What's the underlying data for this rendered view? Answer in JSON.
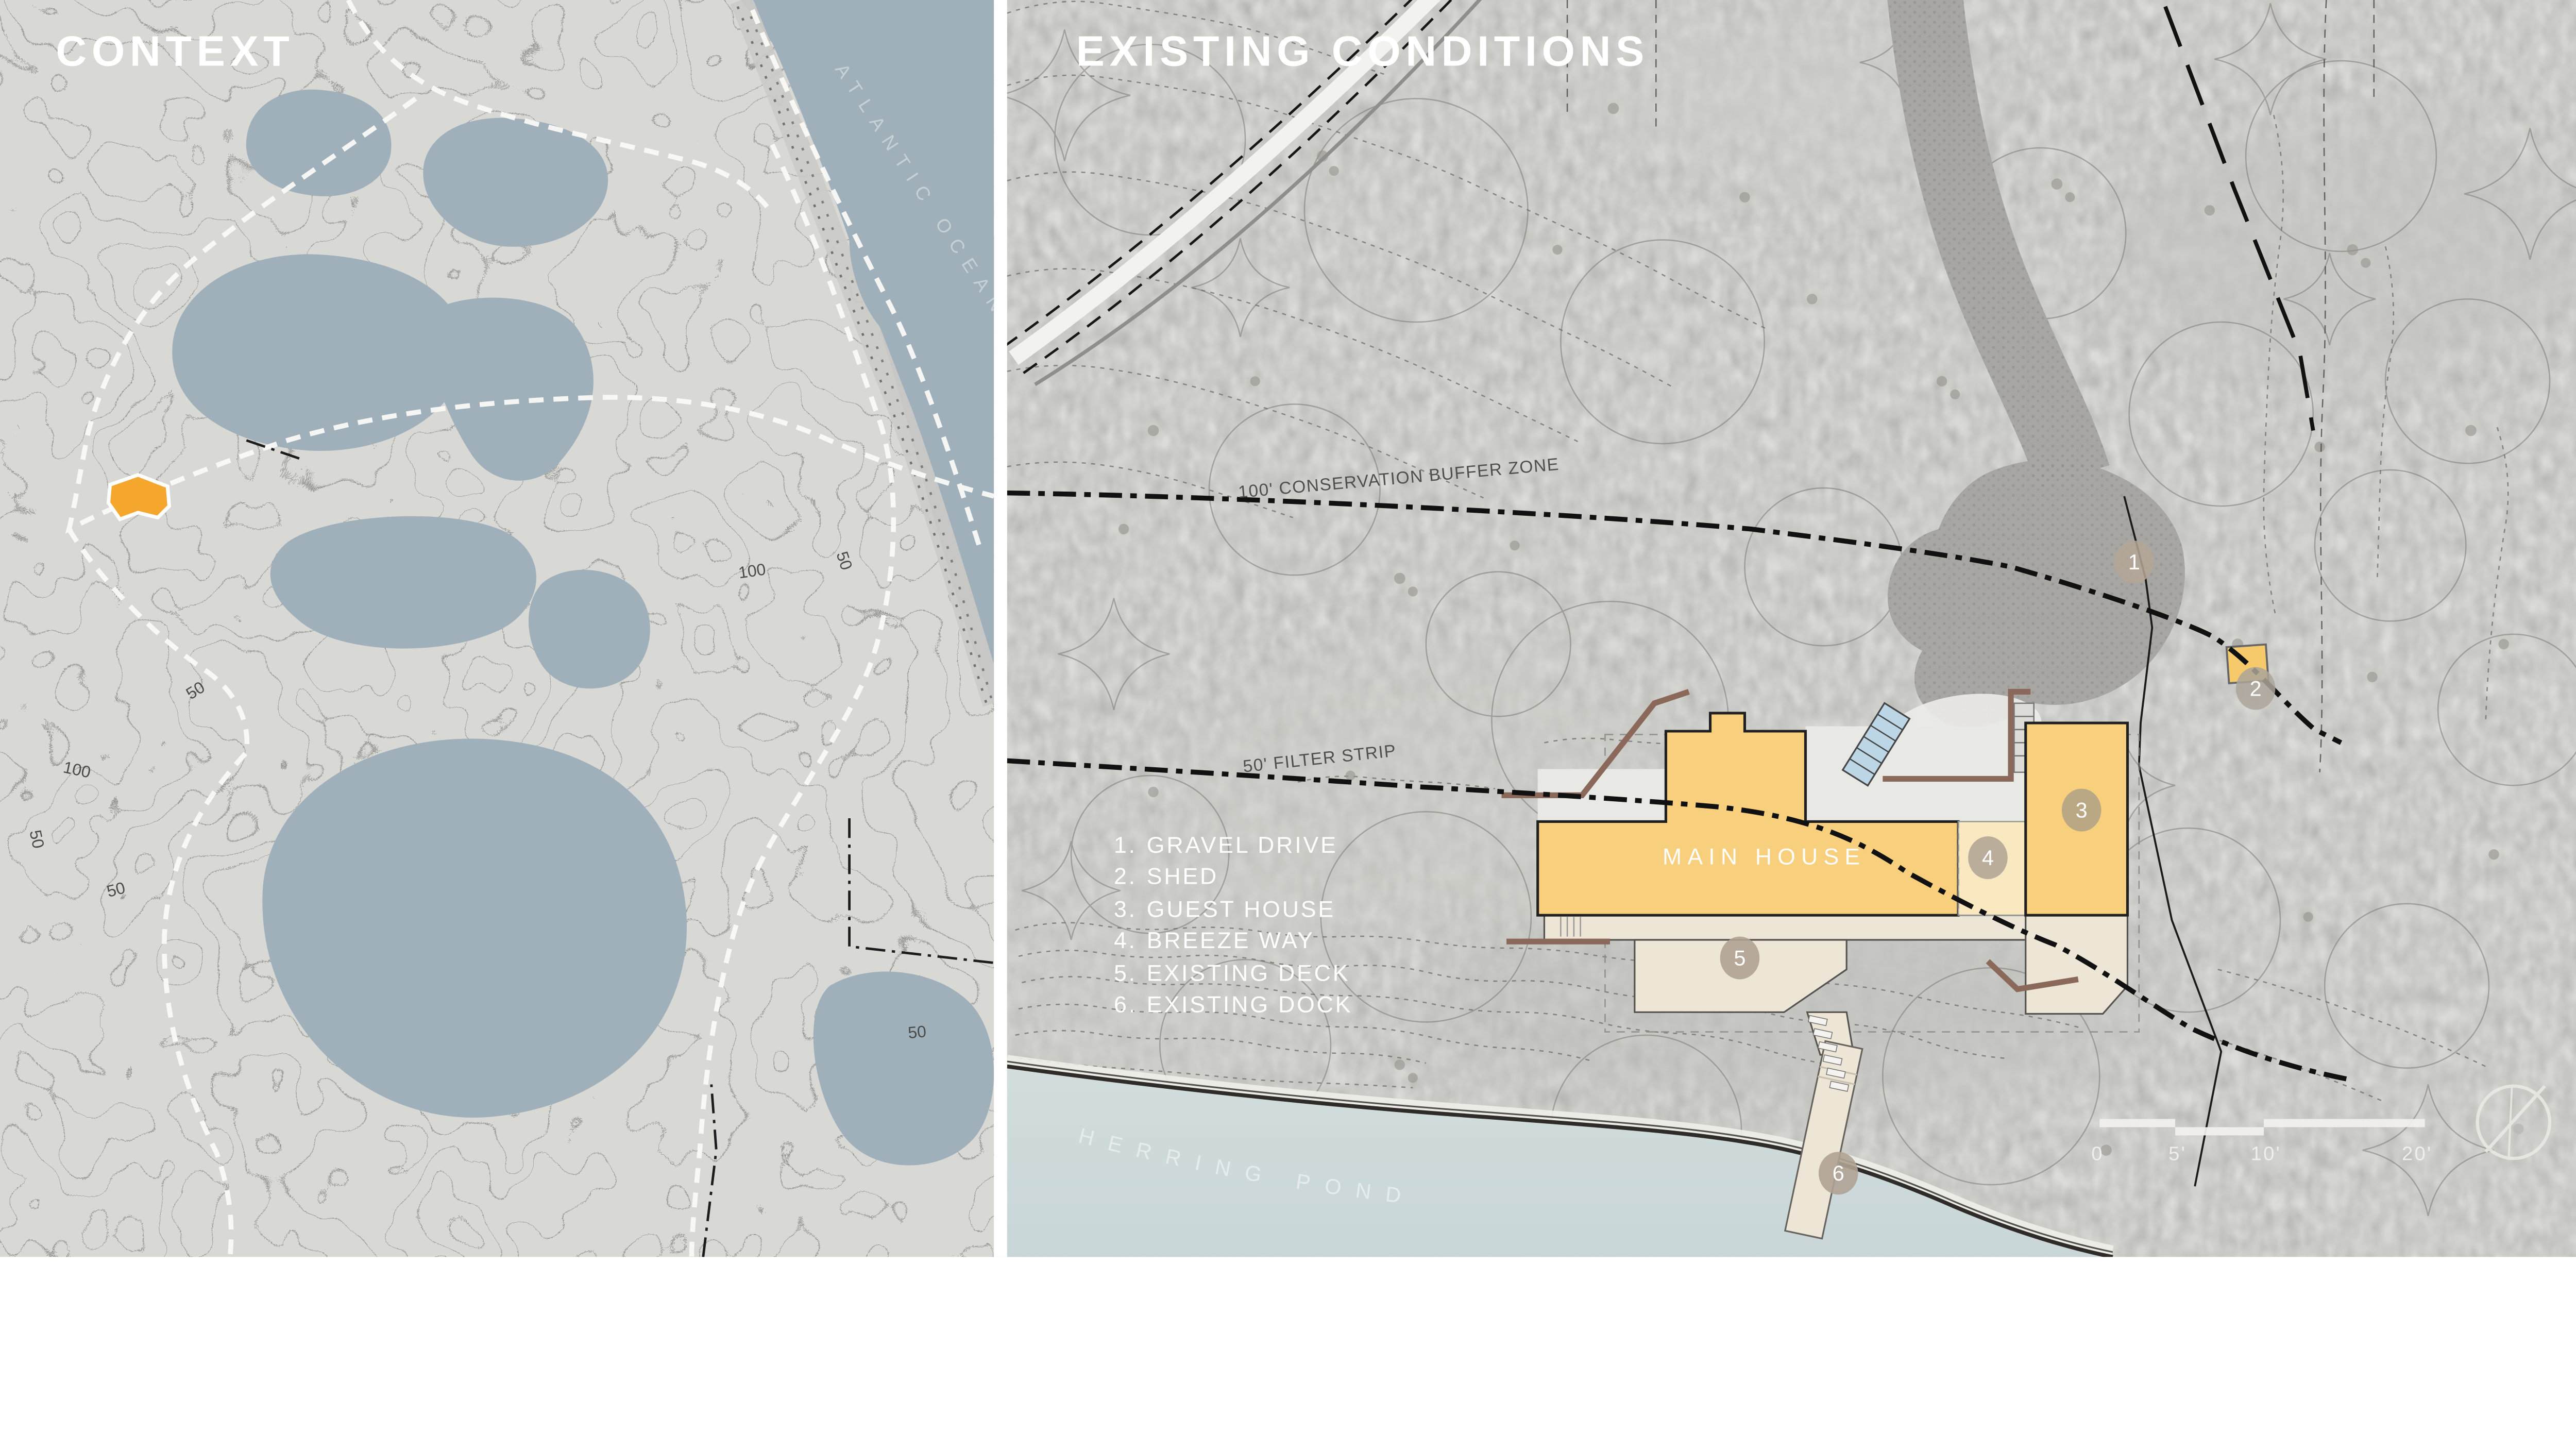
{
  "context_panel": {
    "title": "CONTEXT",
    "ocean_label": "ATLANTIC OCEAN",
    "contour_labels": [
      "100",
      "50",
      "100",
      "50",
      "50",
      "50",
      "50"
    ],
    "site_color": "#F5A72D",
    "water_color": "#9FB0BA"
  },
  "existing_panel": {
    "title": "EXISTING CONDITIONS",
    "buffer_line_label": "100' CONSERVATION BUFFER ZONE",
    "filter_line_label": "50' FILTER STRIP",
    "main_house_label": "MAIN HOUSE",
    "pond_label": "HERRING POND",
    "legend": {
      "items": [
        {
          "num": "1.",
          "label": "GRAVEL DRIVE"
        },
        {
          "num": "2.",
          "label": "SHED"
        },
        {
          "num": "3.",
          "label": "GUEST HOUSE"
        },
        {
          "num": "4.",
          "label": "BREEZE WAY"
        },
        {
          "num": "5.",
          "label": "EXISTING DECK"
        },
        {
          "num": "6.",
          "label": "EXISTING DOCK"
        }
      ]
    },
    "markers": [
      "1",
      "2",
      "3",
      "4",
      "5",
      "6"
    ],
    "scale_bar": {
      "labels": [
        "0",
        "5'",
        "10'",
        "20'"
      ]
    },
    "colors": {
      "house": "#F7CF7D",
      "breezeway": "#FAE8C0",
      "deck": "#EDE5D5",
      "water": "#CFDCDC",
      "gravel_drive": "#A8A6A2",
      "marker": "#B3A695",
      "shed": "#F6C96B"
    }
  }
}
